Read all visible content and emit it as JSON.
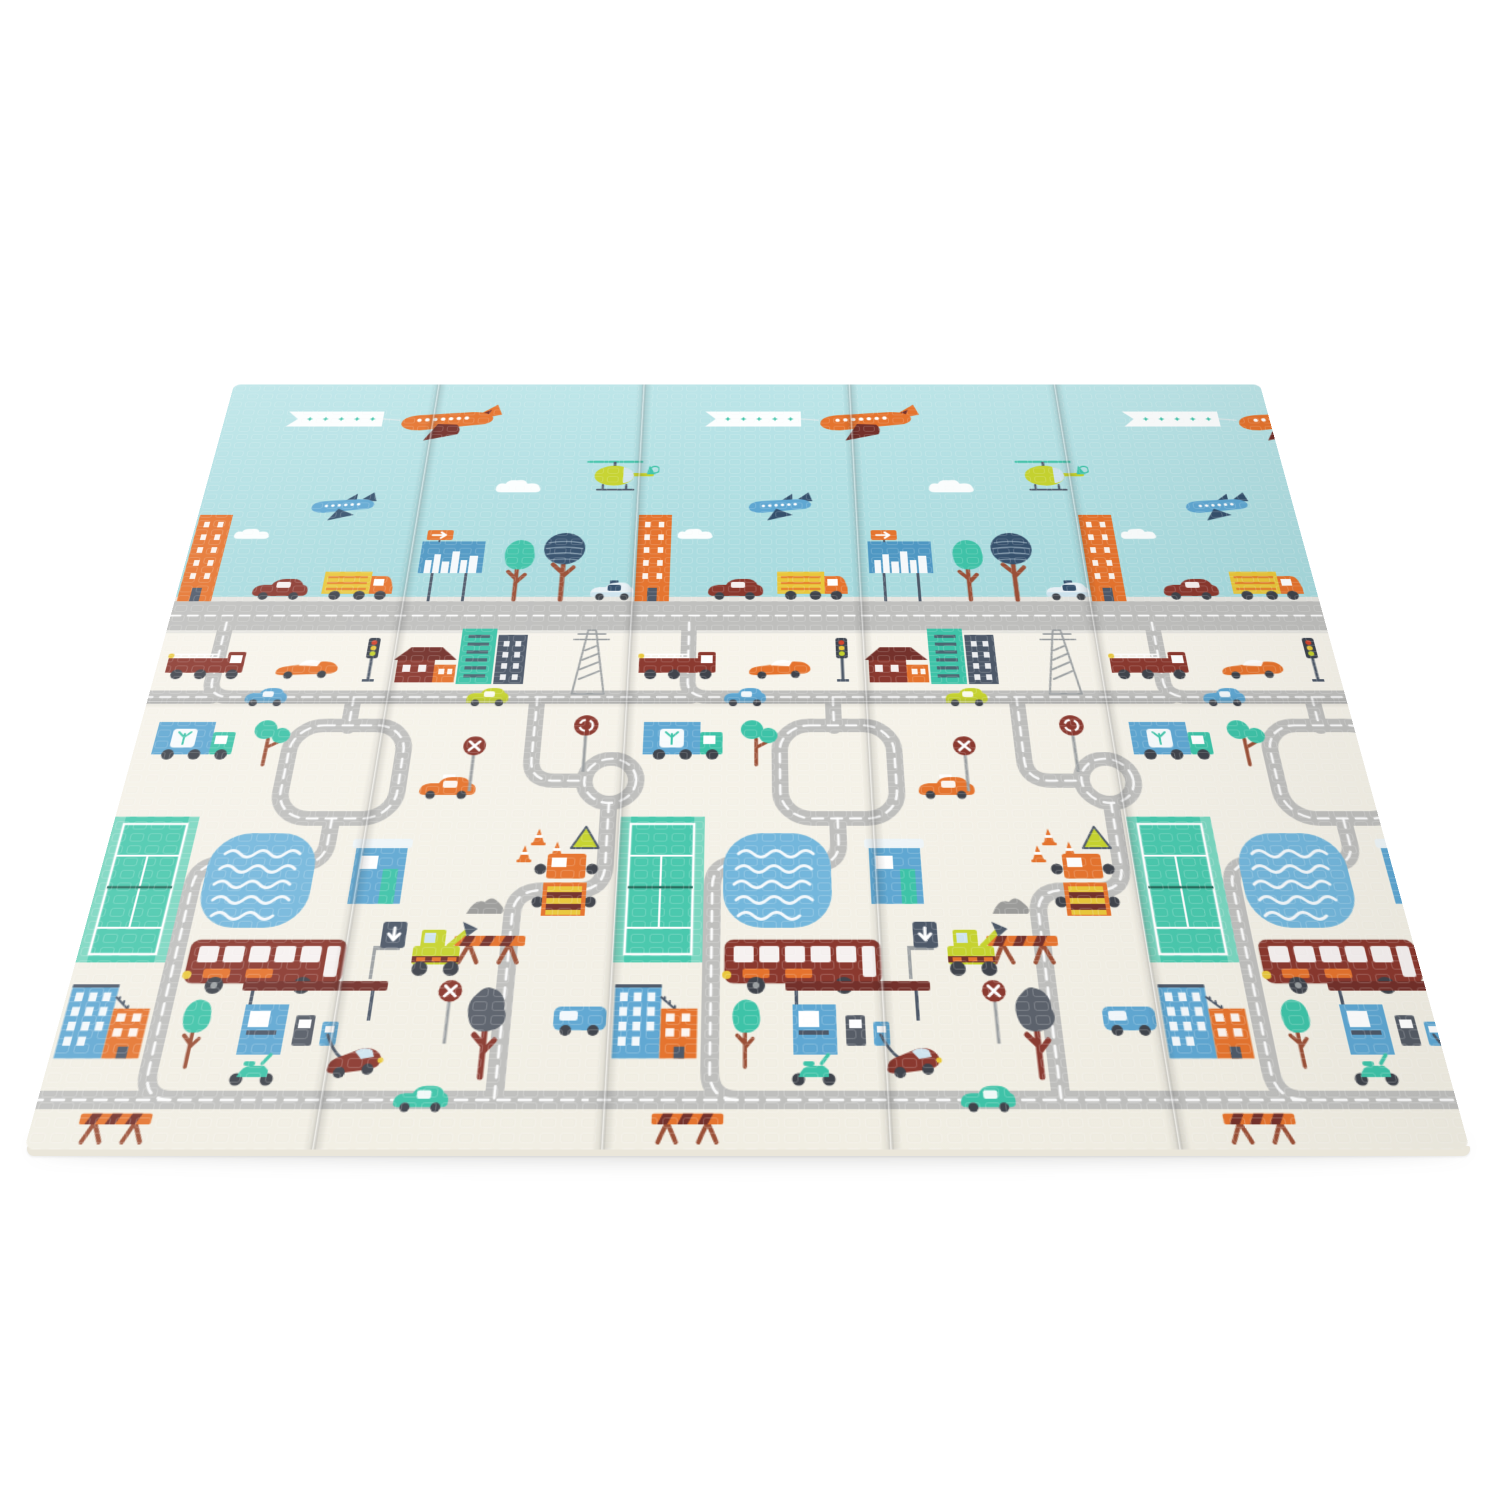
{
  "scene": {
    "type": "product-photo",
    "description": "Foldable baby play mat with a cartoon city print: teal-blue sky with airplanes, a helicopter and clouds above a city skyline, and a cream play field covered with winding gray roads, buildings, vehicles, a tennis court and a swimming pool. The mat is shown tilted in perspective on a plain white background.",
    "background_color": "#ffffff"
  },
  "palette": {
    "sky": "#a7dade",
    "skyTop": "#bce5e8",
    "cream": "#f7f4eb",
    "creamDark": "#f1eee3",
    "road": "#bfbfbd",
    "roadDash": "#ffffff",
    "sidewalk": "#e6e5e0",
    "orange": "#e5732d",
    "darkRed": "#8a382e",
    "darkerRed": "#73302a",
    "teal": "#3ec3a8",
    "tealLight": "#7ad6c0",
    "courtTeal": "#49c8ad",
    "blue": "#5fa7d2",
    "poolBlue": "#74b7dc",
    "lightBlue": "#cfe4ef",
    "navy": "#35506c",
    "yellow": "#e9c73b",
    "yellowGreen": "#c6d32f",
    "gray": "#9b9fa1",
    "darkSlate": "#4d5868",
    "brown": "#9a4f36",
    "billboardBlue": "#4e97c3",
    "wheel": "#3f434b",
    "white": "#ffffff",
    "grayTree": "#5b616b",
    "gravel": "#9b9b99",
    "matEdge": "#eae6da"
  },
  "mat": {
    "panels": 5,
    "vertical_fold_lines": 4,
    "horizontal_fold_lines": 1,
    "perspective": "tilted back, top edge receding, bottom edge nearest",
    "sections": {
      "sky": "light teal sky band with star banner plane, small blue plane, helicopter and white clouds",
      "skyline": "city row with orange tower, cars, delivery truck, skyline billboard with arrow sign, teal and navy trees above a straight gray road",
      "play_area": "cream field with winding dashed gray roads, roundabout, tennis court, pool, bus, gas station, construction vehicles, signs and houses"
    }
  },
  "objects": {
    "sky": [
      "star-banner",
      "orange-airplane",
      "blue-airplane",
      "helicopter",
      "clouds"
    ],
    "skyline": [
      "orange-building",
      "dark-red-car",
      "yellow-delivery-truck",
      "city-billboard",
      "arrow-sign",
      "teal-tree",
      "navy-striped-tree",
      "police-car",
      "main-road"
    ],
    "play_area": [
      "fire-truck",
      "orange-sports-car",
      "traffic-light",
      "red-house",
      "teal-building",
      "gray-building",
      "power-tower",
      "blue-car",
      "green-car",
      "wheat-delivery-truck",
      "twin-teal-tree",
      "orange-taxi",
      "no-entry-sign",
      "roundabout-sign",
      "traffic-cones",
      "warning-triangle",
      "crane-truck",
      "gravel-pile",
      "road-barrier",
      "tennis-court",
      "swimming-pool",
      "blue-kiosk",
      "city-bus",
      "excavator",
      "blue-orange-apartment",
      "small-teal-tree",
      "gas-station",
      "scooter",
      "red-sports-car",
      "gray-tree",
      "down-arrow-sign",
      "teal-car",
      "blue-van",
      "winding-roads",
      "roundabout"
    ]
  }
}
